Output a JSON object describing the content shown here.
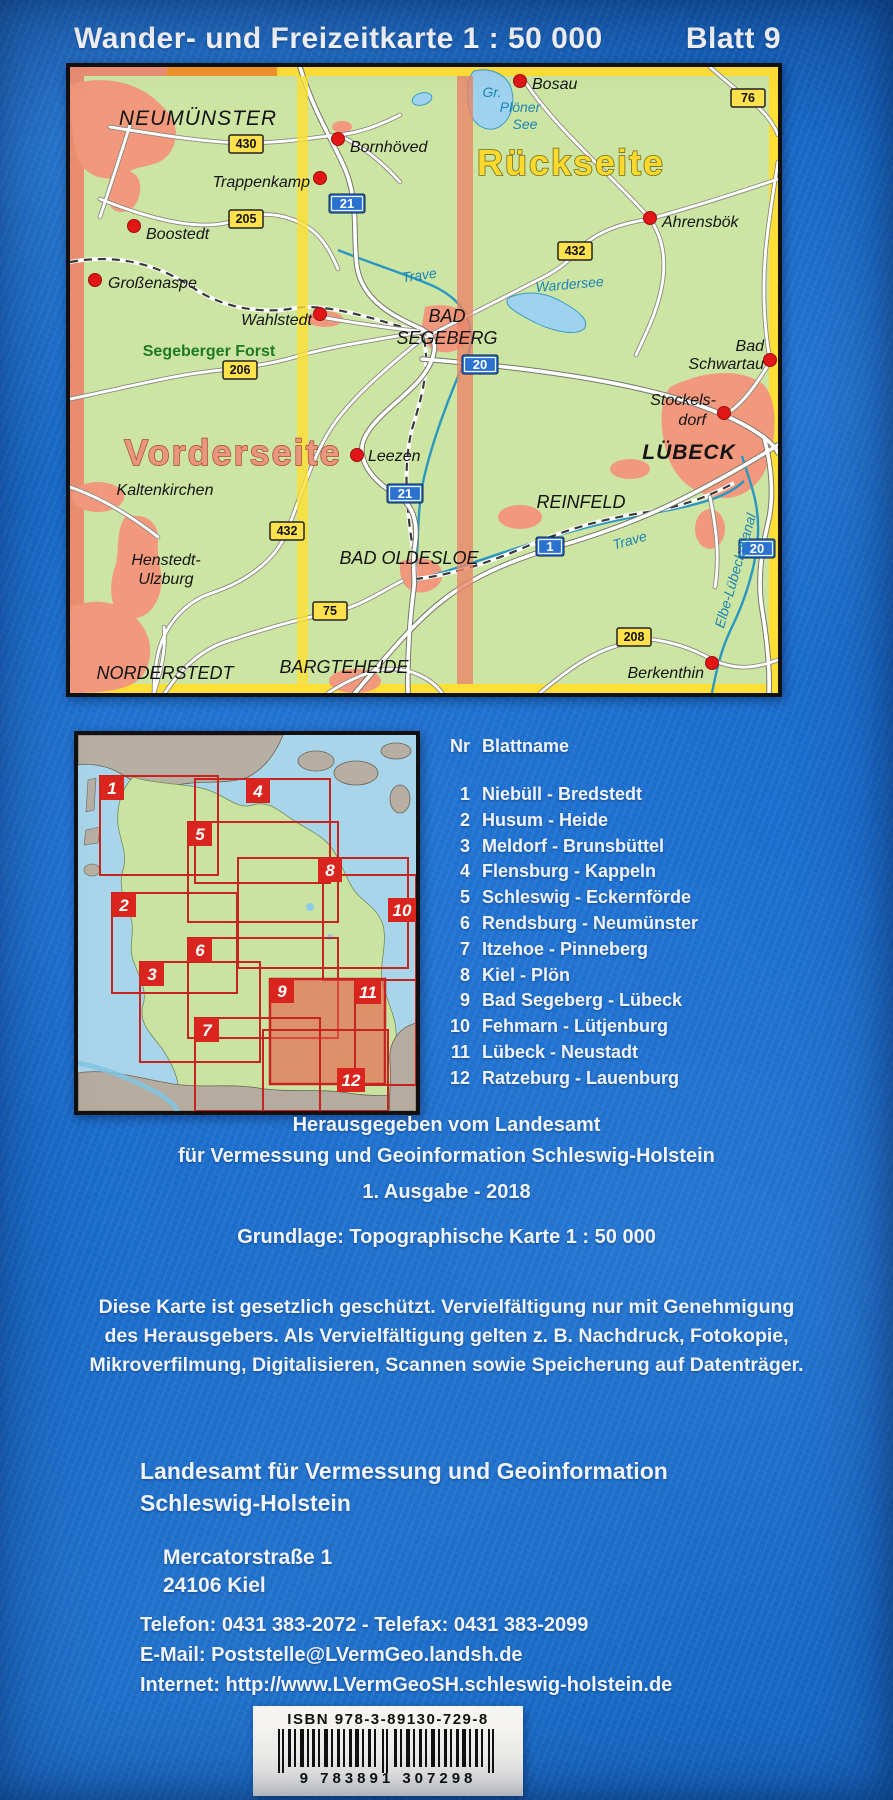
{
  "header": {
    "title": "Wander- und Freizeitkarte 1 : 50 000",
    "sheet": "Blatt 9"
  },
  "map": {
    "front_label": "Vorderseite",
    "back_label": "Rückseite",
    "labels": {
      "neumuenster": "NEUMÜNSTER",
      "bornhoeved": "Bornhöved",
      "trappenkamp": "Trappenkamp",
      "boostedt": "Boostedt",
      "grossenaspe": "Großenaspe",
      "wahlstedt": "Wahlstedt",
      "bad_segeberg_1": "BAD",
      "bad_segeberg_2": "SEGEBERG",
      "segeberger_forst": "Segeberger Forst",
      "leezen": "Leezen",
      "kaltenkirchen": "Kaltenkirchen",
      "henstedt_1": "Henstedt-",
      "henstedt_2": "Ulzburg",
      "norderstedt": "NORDERSTEDT",
      "bargteheide": "BARGTEHEIDE",
      "bad_oldesloe": "BAD OLDESLOE",
      "bosau": "Bosau",
      "gr_ploener_1": "Gr.",
      "gr_ploener_2": "Plöner",
      "gr_ploener_3": "See",
      "ahrensboek": "Ahrensbök",
      "wardersee": "Wardersee",
      "bad_schwartau_1": "Bad",
      "bad_schwartau_2": "Schwartau",
      "stockelsdorf_1": "Stockels-",
      "stockelsdorf_2": "dorf",
      "luebeck": "LÜBECK",
      "reinfeld": "REINFELD",
      "trave_upper": "Trave",
      "trave_lower": "Trave",
      "kanal": "Elbe-Lübeck-Kanal",
      "berkenthin": "Berkenthin"
    },
    "badges_yellow": [
      "430",
      "205",
      "206",
      "432",
      "75",
      "432",
      "76",
      "208"
    ],
    "badges_blue": [
      "21",
      "21",
      "20",
      "1",
      "20"
    ]
  },
  "index_map": {
    "numbers": [
      "1",
      "2",
      "3",
      "4",
      "5",
      "6",
      "7",
      "8",
      "9",
      "10",
      "11",
      "12"
    ]
  },
  "sheet_list": {
    "header_nr": "Nr",
    "header_name": "Blattname",
    "items": [
      {
        "nr": "1",
        "name": "Niebüll - Bredstedt"
      },
      {
        "nr": "2",
        "name": "Husum - Heide"
      },
      {
        "nr": "3",
        "name": "Meldorf - Brunsbüttel"
      },
      {
        "nr": "4",
        "name": "Flensburg - Kappeln"
      },
      {
        "nr": "5",
        "name": "Schleswig - Eckernförde"
      },
      {
        "nr": "6",
        "name": "Rendsburg - Neumünster"
      },
      {
        "nr": "7",
        "name": "Itzehoe - Pinneberg"
      },
      {
        "nr": "8",
        "name": "Kiel - Plön"
      },
      {
        "nr": "9",
        "name": "Bad Segeberg - Lübeck"
      },
      {
        "nr": "10",
        "name": "Fehmarn - Lütjenburg"
      },
      {
        "nr": "11",
        "name": "Lübeck - Neustadt"
      },
      {
        "nr": "12",
        "name": "Ratzeburg - Lauenburg"
      }
    ]
  },
  "publisher": {
    "line1": "Herausgegeben vom Landesamt",
    "line2": "für Vermessung und Geoinformation Schleswig-Holstein",
    "edition": "1. Ausgabe  -  2018",
    "basis": "Grundlage: Topographische Karte 1 : 50 000"
  },
  "copyright": {
    "line1": "Diese Karte ist gesetzlich geschützt.  Vervielfältigung nur mit Genehmigung",
    "line2": "des Herausgebers.  Als Vervielfältigung gelten z. B.  Nachdruck,   Fotokopie,",
    "line3": "Mikroverfilmung, Digitalisieren, Scannen sowie Speicherung auf Datenträger."
  },
  "address": {
    "org_line1": "Landesamt für Vermessung und Geoinformation",
    "org_line2": "Schleswig-Holstein",
    "street": "Mercatorstraße 1",
    "city": "24106 Kiel"
  },
  "contact": {
    "phone": "Telefon: 0431 383-2072  -  Telefax: 0431 383-2099",
    "email": "E-Mail: Poststelle@LVermGeo.landsh.de",
    "web": "Internet: http://www.LVermGeoSH.schleswig-holstein.de"
  },
  "isbn": {
    "label": "ISBN 978-3-89130-729-8",
    "digits": "9 783891 307298"
  },
  "colors": {
    "background": "#1566c2",
    "map_land": "#cde5a3",
    "urban": "#f2997d",
    "highlight_yellow": "#ffdf35",
    "highlight_salmon": "#ec8f72",
    "sheet_red": "#d9251d",
    "water": "#9fd2ee"
  }
}
